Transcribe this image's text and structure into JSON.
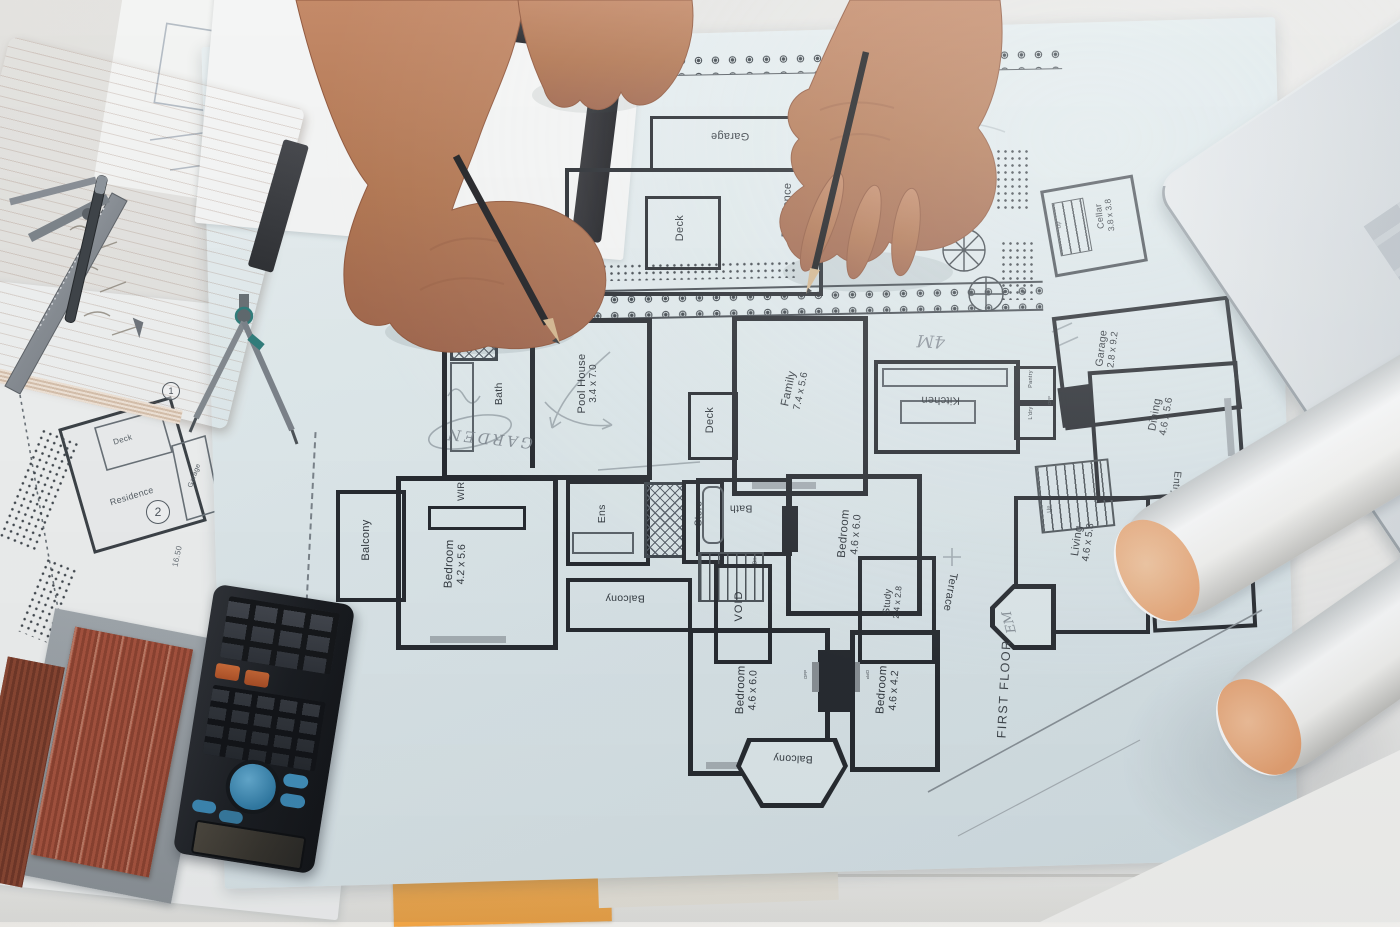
{
  "plan": {
    "title": "FIRST FLOOR",
    "rooms": {
      "garage_top": {
        "name": "Garage"
      },
      "residence": {
        "name": "Residence"
      },
      "deck_top": {
        "name": "Deck"
      },
      "cellar": {
        "name": "Cellar",
        "dims": "3.8 x 3.8"
      },
      "bath_pool": {
        "name": "Bath"
      },
      "pool_house": {
        "name": "Pool House",
        "dims": "3.4 x 7.0"
      },
      "deck_mid": {
        "name": "Deck"
      },
      "family": {
        "name": "Family",
        "dims": "7.4 x 5.6"
      },
      "kitchen": {
        "name": "Kitchen"
      },
      "pantry": {
        "name": "Pantry"
      },
      "ldry": {
        "name": "L'dry"
      },
      "garage_right": {
        "name": "Garage",
        "dims": "2.8 x 9.2"
      },
      "dining": {
        "name": "Dining",
        "dims": "4.6 x 5.6"
      },
      "entry": {
        "name": "Entry"
      },
      "verandah": {
        "name": "Verandah"
      },
      "living": {
        "name": "Living",
        "dims": "4.6 x 5.8"
      },
      "study_right": {
        "name": "Study",
        "dims": "4.6 x 4.2"
      },
      "balcony_left": {
        "name": "Balcony"
      },
      "wir": {
        "name": "WIR"
      },
      "bedroom_1": {
        "name": "Bedroom",
        "dims": "4.2 x 5.6"
      },
      "ens": {
        "name": "Ens"
      },
      "store": {
        "name": "Store"
      },
      "balcony_mid": {
        "name": "Balcony"
      },
      "bath_first": {
        "name": "Bath"
      },
      "bedroom_2": {
        "name": "Bedroom",
        "dims": "4.6 x 6.0"
      },
      "void": {
        "name": "VOID"
      },
      "study_small": {
        "name": "Study",
        "dims": "2.4 x 2.8"
      },
      "terrace": {
        "name": "Terrace"
      },
      "bedroom_3": {
        "name": "Bedroom",
        "dims": "4.6 x 6.0"
      },
      "bedroom_4": {
        "name": "Bedroom",
        "dims": "4.6 x 4.2"
      },
      "balcony_bottom": {
        "name": "Balcony"
      }
    },
    "stair_labels": {
      "up": "Up",
      "dn": "Dn"
    },
    "fireplace_label": "OFP",
    "handwritten": {
      "garden": "GARDEN",
      "four_m": "4M",
      "em": "EM"
    }
  },
  "site_plan": {
    "deck": "Deck",
    "residence": "Residence",
    "garage": "Garage",
    "marker_1": "1",
    "marker_2": "2",
    "dimension": "16.50"
  },
  "colors": {
    "blueprint_paper": "#e3edf0",
    "wall_ink": "#23262b",
    "desk": "#e9e7e3",
    "skin": "#b97a5c",
    "notebook_page": "#eed7c6",
    "swatch_brick": "#9e4a33",
    "sticky_note": "#f3aa4e",
    "tube_end": "#f0b48a",
    "laptop_body": "#ccd1d5",
    "calculator_body": "#17191d",
    "calc_dpad": "#3f8fbc"
  }
}
